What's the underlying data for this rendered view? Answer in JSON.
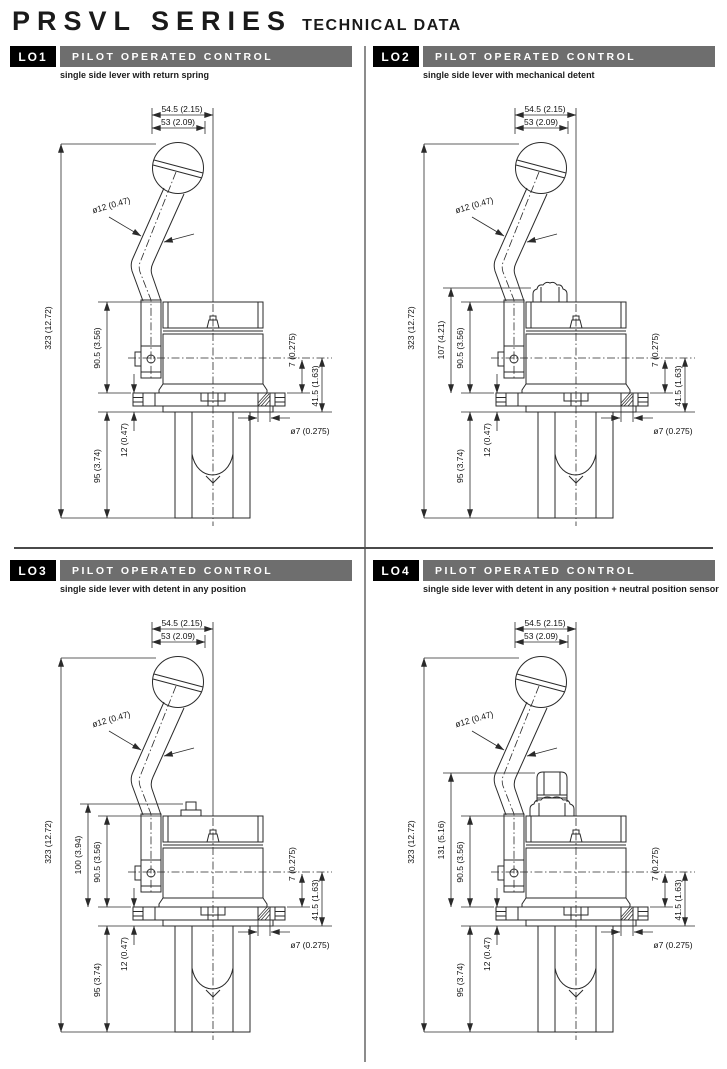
{
  "page": {
    "title": "PRSVL SERIES",
    "subtitle": "TECHNICAL DATA"
  },
  "colors": {
    "code_box_bg": "#000000",
    "header_bar_bg": "#6e6e6e",
    "header_text": "#ffffff",
    "drawing_line": "#2a2a2a",
    "divider": "#8c8c8c"
  },
  "panels": [
    {
      "code": "LO1",
      "title": "PILOT OPERATED CONTROL",
      "description": "single side lever with return spring",
      "variant": "return-spring",
      "dims": {
        "lever_top_width": "54.5 (2.15)",
        "knob_width": "53 (2.09)",
        "lever_diameter": "ø12 (0.47)",
        "overall_height": "323 (12.72)",
        "body_height": "90.5 (3.56)",
        "recess_depth": "12 (0.47)",
        "below_plate_height": "95 (3.74)",
        "flange_thickness": "7 (0.275)",
        "axis_to_base": "41.5 (1.63)",
        "mounting_hole_diameter": "ø7 (0.275)"
      }
    },
    {
      "code": "LO2",
      "title": "PILOT OPERATED CONTROL",
      "description": "single side lever with mechanical detent",
      "variant": "mechanical-detent",
      "dims": {
        "lever_top_width": "54.5 (2.15)",
        "knob_width": "53 (2.09)",
        "lever_diameter": "ø12 (0.47)",
        "overall_height": "323 (12.72)",
        "extra_height": "107 (4.21)",
        "body_height": "90.5 (3.56)",
        "recess_depth": "12 (0.47)",
        "below_plate_height": "95 (3.74)",
        "flange_thickness": "7 (0.275)",
        "axis_to_base": "41.5 (1.63)",
        "mounting_hole_diameter": "ø7 (0.275)"
      }
    },
    {
      "code": "LO3",
      "title": "PILOT OPERATED CONTROL",
      "description": "single side lever with detent in any position",
      "variant": "detent-any-position",
      "dims": {
        "lever_top_width": "54.5 (2.15)",
        "knob_width": "53 (2.09)",
        "lever_diameter": "ø12 (0.47)",
        "overall_height": "323 (12.72)",
        "extra_height": "100 (3.94)",
        "body_height": "90.5 (3.56)",
        "recess_depth": "12 (0.47)",
        "below_plate_height": "95 (3.74)",
        "flange_thickness": "7 (0.275)",
        "axis_to_base": "41.5 (1.63)",
        "mounting_hole_diameter": "ø7 (0.275)"
      }
    },
    {
      "code": "LO4",
      "title": "PILOT OPERATED CONTROL",
      "description": "single side lever with detent in any position + neutral position sensor",
      "variant": "detent-neutral-sensor",
      "dims": {
        "lever_top_width": "54.5 (2.15)",
        "knob_width": "53 (2.09)",
        "lever_diameter": "ø12 (0.47)",
        "overall_height": "323 (12.72)",
        "extra_height": "131 (5.16)",
        "body_height": "90.5 (3.56)",
        "recess_depth": "12 (0.47)",
        "below_plate_height": "95 (3.74)",
        "flange_thickness": "7 (0.275)",
        "axis_to_base": "41.5 (1.63)",
        "mounting_hole_diameter": "ø7 (0.275)"
      }
    }
  ]
}
